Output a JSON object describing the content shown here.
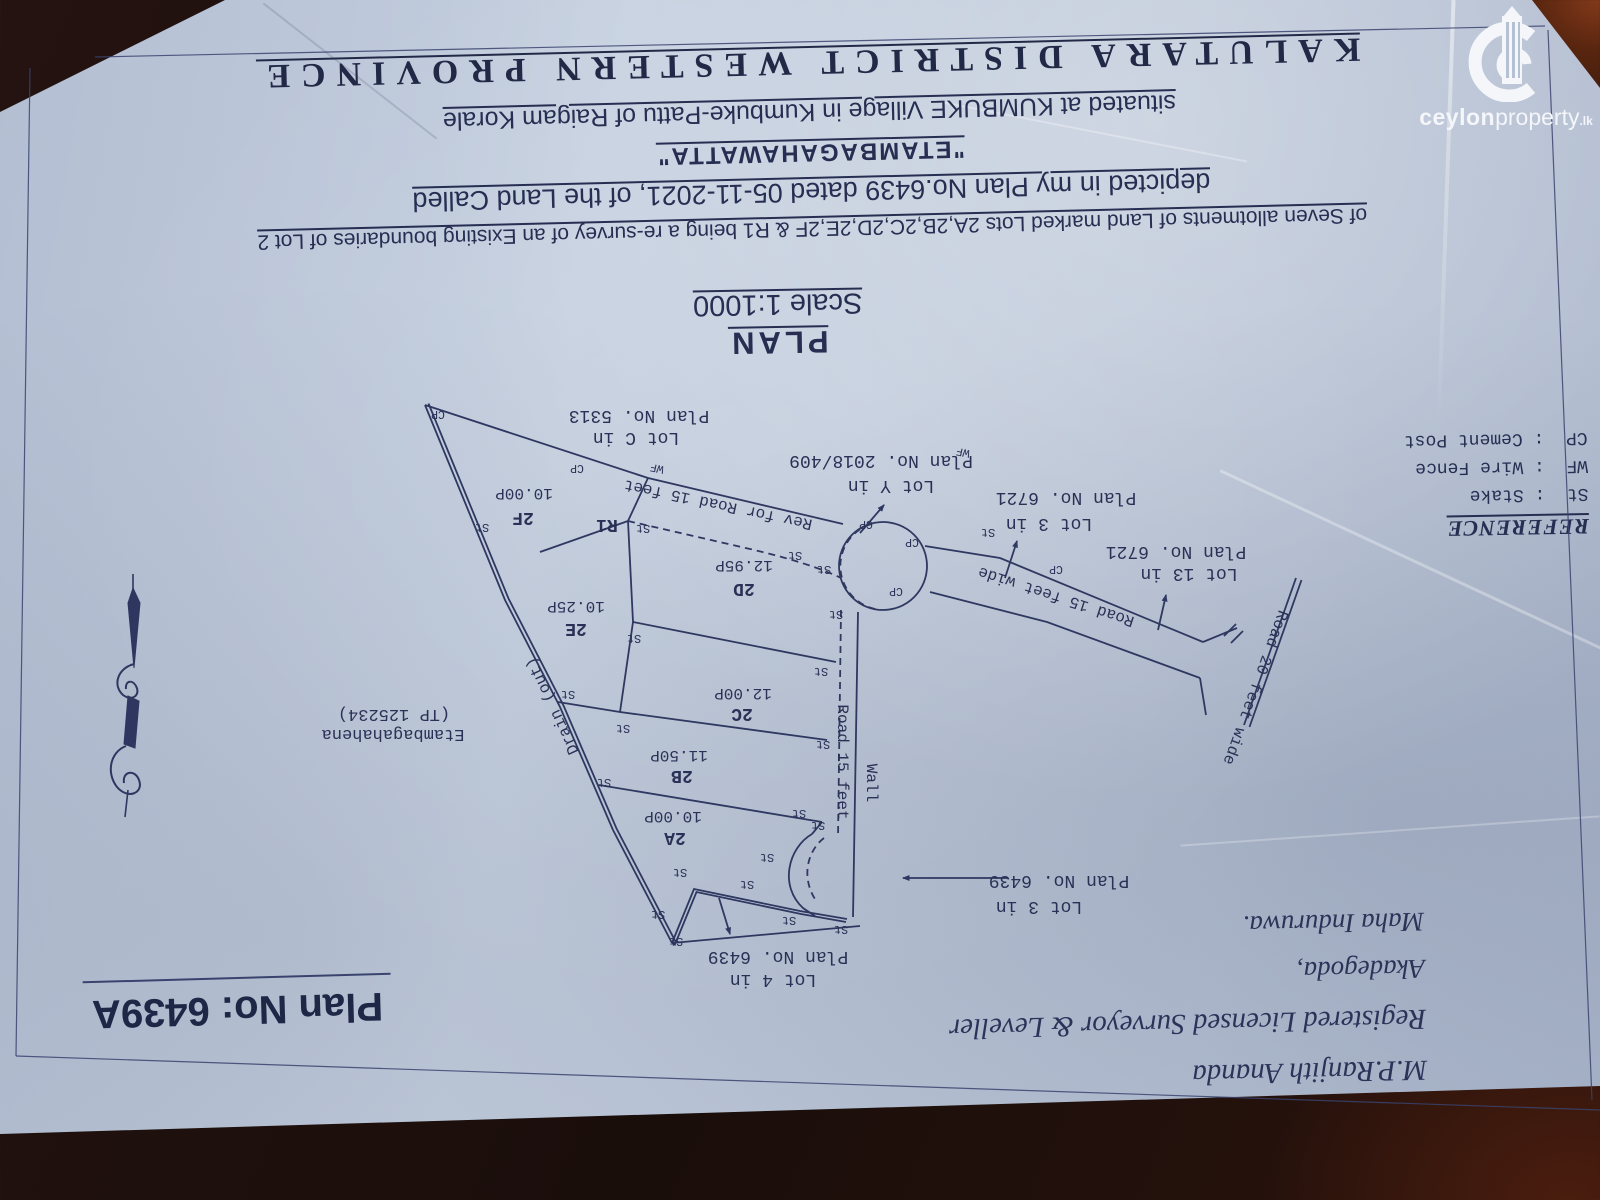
{
  "watermark": {
    "brand_bold": "ceylon",
    "brand_light": "property",
    "brand_tld": ".lk"
  },
  "header": {
    "plan_word": "PLAN",
    "scale": "Scale 1:1000",
    "line_allotments": "of Seven allotments of Land marked Lots 2A,2B,2C,2D,2E,2F & R1 being a re-survey of an Existing boundaries of Lot 2",
    "line_depicted": "depicted in my Plan No.6439  dated 05-11-2021, of the Land Called",
    "line_name": "\"ETAMBAGAHAWATTA\"",
    "line_situated": "situated at KUMBUKE Village in Kumbuke-Pattu of Raigam Korale",
    "line_district": "KALUTARA DISTRICT WESTERN PROVINCE"
  },
  "reference": {
    "title": "REFERENCE",
    "sep": ":",
    "items": [
      {
        "abbr": "St",
        "meaning": "Stake"
      },
      {
        "abbr": "WF",
        "meaning": "Wire Fence"
      },
      {
        "abbr": "CP",
        "meaning": "Cement Post"
      }
    ]
  },
  "plan_box": {
    "label": "Plan No: 6439A"
  },
  "surveyor": {
    "name": "M.P.Ranjith Ananda",
    "title": "Registered Licensed Surveyor & Leveller",
    "address1": "Akadegoda,",
    "address2": "Maha Induruwa."
  },
  "diagram": {
    "scale_text": "Scale 1:1000",
    "labels": {
      "lotC1": "Lot C in",
      "lotC2": "Plan No. 5313",
      "lotY1": "Lot Y in",
      "lotY2": "Plan No. 2018/409",
      "lot3a1": "Lot 3 in",
      "lot3a2": "Plan No. 6721",
      "lot13_1": "Lot 13 in",
      "lot13_2": "Plan No. 6721",
      "lot3b1": "Lot 3 in",
      "lot3b2": "Plan No. 6439",
      "lot4_1": "Lot 4 in",
      "lot4_2": "Plan No. 6439",
      "f_id": "2F",
      "f_area": "10.00P",
      "d_id": "2D",
      "d_area": "12.95P",
      "e_id": "2E",
      "e_area": "10.25P",
      "c_id": "2C",
      "c_area": "12.00P",
      "b_id": "2B",
      "b_area": "11.50P",
      "a_id": "2A",
      "a_area": "10.00P",
      "r1": "R1",
      "rev_road": "Rev for Road 15 feet",
      "road15wide": "Road 15 feet wide",
      "road20": "Road 20 feet wide",
      "road15": "Road 15 feet",
      "wall": "Wall",
      "drain": "Drain (out)",
      "neigh1": "Etambagahahena",
      "neigh2": "(TP 125234)",
      "st": "St",
      "wf": "WF",
      "cp": "CP"
    }
  }
}
